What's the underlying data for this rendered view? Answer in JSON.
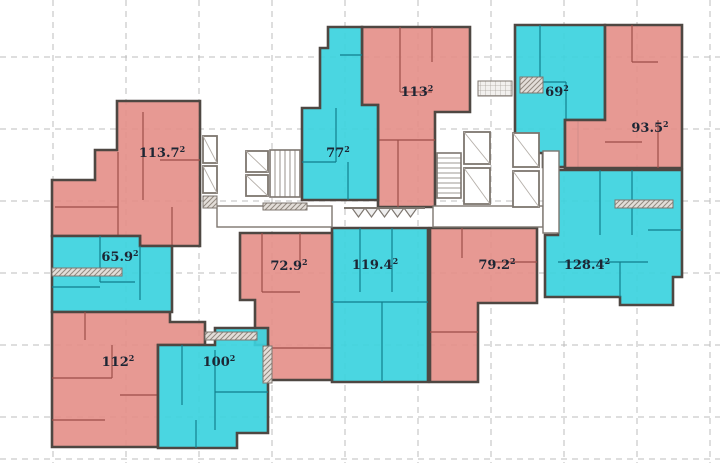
{
  "plan": {
    "colors": {
      "background": "#ffffff",
      "red_fill": "#e5908a",
      "red_wall": "#9c4f49",
      "cyan_fill": "#3bd2de",
      "cyan_wall": "#137f8d",
      "outline": "#4e4742",
      "grid": "#bcbcbc",
      "label": "#1d2634",
      "core": "#7d766f",
      "core_fill": "#ffffff",
      "canopy_fill": "#eeeeee",
      "hatch": "#938a81"
    },
    "grid": {
      "vlines": [
        53,
        126,
        199,
        272,
        345,
        418,
        491,
        564,
        637,
        710
      ],
      "hlines": [
        57,
        129,
        201,
        273,
        345,
        417,
        459
      ],
      "dash": "6 5"
    },
    "units": [
      {
        "id": "unit-113-7",
        "area": "113.7",
        "sup": "2",
        "type": "red",
        "label": [
          162,
          157
        ],
        "points": [
          [
            117,
            101
          ],
          [
            200,
            101
          ],
          [
            200,
            246
          ],
          [
            140,
            246
          ],
          [
            140,
            236
          ],
          [
            52,
            236
          ],
          [
            52,
            180
          ],
          [
            95,
            180
          ],
          [
            95,
            150
          ],
          [
            117,
            150
          ]
        ],
        "walls": [
          [
            143,
            112,
            143,
            200
          ],
          [
            118,
            152,
            118,
            236
          ],
          [
            55,
            207,
            118,
            207
          ],
          [
            160,
            160,
            200,
            160
          ],
          [
            172,
            207,
            172,
            246
          ]
        ]
      },
      {
        "id": "unit-113",
        "area": "113",
        "sup": "2",
        "type": "red",
        "label": [
          417,
          96
        ],
        "points": [
          [
            362,
            27
          ],
          [
            470,
            27
          ],
          [
            470,
            112
          ],
          [
            435,
            112
          ],
          [
            435,
            207
          ],
          [
            378,
            207
          ],
          [
            378,
            105
          ],
          [
            362,
            105
          ]
        ],
        "walls": [
          [
            400,
            27,
            400,
            92
          ],
          [
            400,
            92,
            432,
            92
          ],
          [
            432,
            27,
            432,
            62
          ],
          [
            378,
            140,
            435,
            140
          ],
          [
            398,
            140,
            398,
            207
          ]
        ]
      },
      {
        "id": "unit-69",
        "area": "69",
        "sup": "2",
        "type": "cyan",
        "label": [
          557,
          96
        ],
        "points": [
          [
            515,
            25
          ],
          [
            605,
            25
          ],
          [
            605,
            120
          ],
          [
            565,
            120
          ],
          [
            565,
            167
          ],
          [
            543,
            167
          ],
          [
            543,
            153
          ],
          [
            515,
            153
          ]
        ],
        "walls": [
          [
            540,
            25,
            540,
            82
          ],
          [
            540,
            82,
            566,
            82
          ],
          [
            566,
            82,
            566,
            120
          ],
          [
            578,
            120,
            578,
            167
          ]
        ]
      },
      {
        "id": "unit-93-5",
        "area": "93.5",
        "sup": "2",
        "type": "red",
        "label": [
          650,
          132
        ],
        "points": [
          [
            605,
            25
          ],
          [
            682,
            25
          ],
          [
            682,
            168
          ],
          [
            565,
            168
          ],
          [
            565,
            120
          ],
          [
            605,
            120
          ]
        ],
        "walls": [
          [
            632,
            25,
            632,
            62
          ],
          [
            632,
            62,
            658,
            62
          ],
          [
            605,
            142,
            642,
            142
          ],
          [
            658,
            120,
            658,
            168
          ]
        ]
      },
      {
        "id": "unit-77",
        "area": "77",
        "sup": "2",
        "type": "cyan",
        "label": [
          338,
          157
        ],
        "points": [
          [
            328,
            27
          ],
          [
            362,
            27
          ],
          [
            362,
            105
          ],
          [
            378,
            105
          ],
          [
            378,
            200
          ],
          [
            302,
            200
          ],
          [
            302,
            108
          ],
          [
            320,
            108
          ],
          [
            320,
            48
          ],
          [
            328,
            48
          ]
        ],
        "walls": [
          [
            336,
            108,
            336,
            162
          ],
          [
            302,
            162,
            336,
            162
          ],
          [
            340,
            55,
            362,
            55
          ],
          [
            348,
            162,
            348,
            200
          ]
        ]
      },
      {
        "id": "unit-65-9",
        "area": "65.9",
        "sup": "2",
        "type": "cyan",
        "label": [
          120,
          261
        ],
        "points": [
          [
            52,
            236
          ],
          [
            140,
            236
          ],
          [
            140,
            246
          ],
          [
            172,
            246
          ],
          [
            172,
            312
          ],
          [
            52,
            312
          ]
        ],
        "walls": [
          [
            100,
            236,
            100,
            282
          ],
          [
            100,
            282,
            135,
            282
          ],
          [
            140,
            246,
            140,
            300
          ],
          [
            52,
            287,
            100,
            287
          ]
        ]
      },
      {
        "id": "unit-72-9",
        "area": "72.9",
        "sup": "2",
        "type": "red",
        "label": [
          289,
          270
        ],
        "points": [
          [
            240,
            233
          ],
          [
            333,
            233
          ],
          [
            333,
            380
          ],
          [
            268,
            380
          ],
          [
            268,
            345
          ],
          [
            255,
            345
          ],
          [
            255,
            300
          ],
          [
            240,
            300
          ]
        ],
        "walls": [
          [
            262,
            233,
            262,
            292
          ],
          [
            262,
            292,
            300,
            292
          ],
          [
            300,
            233,
            300,
            262
          ],
          [
            272,
            348,
            333,
            348
          ]
        ]
      },
      {
        "id": "unit-119-4",
        "area": "119.4",
        "sup": "2",
        "type": "cyan",
        "label": [
          375,
          269
        ],
        "points": [
          [
            332,
            228
          ],
          [
            428,
            228
          ],
          [
            428,
            382
          ],
          [
            332,
            382
          ]
        ],
        "walls": [
          [
            360,
            228,
            360,
            292
          ],
          [
            392,
            228,
            392,
            292
          ],
          [
            332,
            302,
            428,
            302
          ],
          [
            382,
            302,
            382,
            382
          ]
        ]
      },
      {
        "id": "unit-79-2",
        "area": "79.2",
        "sup": "2",
        "type": "red",
        "label": [
          497,
          269
        ],
        "points": [
          [
            430,
            228
          ],
          [
            537,
            228
          ],
          [
            537,
            303
          ],
          [
            478,
            303
          ],
          [
            478,
            382
          ],
          [
            430,
            382
          ]
        ],
        "walls": [
          [
            462,
            228,
            462,
            258
          ],
          [
            492,
            262,
            537,
            262
          ],
          [
            430,
            332,
            478,
            332
          ]
        ]
      },
      {
        "id": "unit-128-4",
        "area": "128.4",
        "sup": "2",
        "type": "cyan",
        "label": [
          587,
          269
        ],
        "points": [
          [
            558,
            170
          ],
          [
            682,
            170
          ],
          [
            682,
            277
          ],
          [
            673,
            277
          ],
          [
            673,
            305
          ],
          [
            620,
            305
          ],
          [
            620,
            297
          ],
          [
            545,
            297
          ],
          [
            545,
            235
          ],
          [
            558,
            235
          ]
        ],
        "walls": [
          [
            600,
            170,
            600,
            235
          ],
          [
            632,
            170,
            632,
            235
          ],
          [
            558,
            262,
            600,
            262
          ],
          [
            620,
            262,
            620,
            297
          ],
          [
            648,
            230,
            682,
            230
          ],
          [
            600,
            262,
            648,
            262
          ]
        ]
      },
      {
        "id": "unit-112",
        "area": "112",
        "sup": "2",
        "type": "red",
        "label": [
          118,
          366
        ],
        "points": [
          [
            52,
            312
          ],
          [
            170,
            312
          ],
          [
            170,
            322
          ],
          [
            205,
            322
          ],
          [
            205,
            345
          ],
          [
            158,
            345
          ],
          [
            158,
            447
          ],
          [
            52,
            447
          ]
        ],
        "walls": [
          [
            52,
            378,
            112,
            378
          ],
          [
            112,
            345,
            112,
            378
          ],
          [
            85,
            312,
            85,
            340
          ],
          [
            120,
            395,
            158,
            395
          ],
          [
            52,
            420,
            105,
            420
          ]
        ]
      },
      {
        "id": "unit-100",
        "area": "100",
        "sup": "2",
        "type": "cyan",
        "label": [
          219,
          366
        ],
        "points": [
          [
            158,
            345
          ],
          [
            215,
            345
          ],
          [
            215,
            328
          ],
          [
            268,
            328
          ],
          [
            268,
            433
          ],
          [
            237,
            433
          ],
          [
            237,
            448
          ],
          [
            158,
            448
          ]
        ],
        "walls": [
          [
            215,
            350,
            215,
            430
          ],
          [
            215,
            392,
            268,
            392
          ],
          [
            182,
            345,
            182,
            405
          ],
          [
            196,
            420,
            196,
            448
          ]
        ]
      }
    ],
    "cores": {
      "stairs": [
        {
          "x": 270,
          "y": 150,
          "w": 30,
          "h": 47,
          "dir": "v"
        },
        {
          "x": 437,
          "y": 153,
          "w": 24,
          "h": 45,
          "dir": "h"
        }
      ],
      "lifts": [
        {
          "x": 246,
          "y": 151,
          "w": 22,
          "h": 21
        },
        {
          "x": 246,
          "y": 175,
          "w": 22,
          "h": 21
        },
        {
          "x": 464,
          "y": 132,
          "w": 26,
          "h": 32
        },
        {
          "x": 464,
          "y": 168,
          "w": 26,
          "h": 36
        },
        {
          "x": 513,
          "y": 133,
          "w": 26,
          "h": 34
        },
        {
          "x": 513,
          "y": 171,
          "w": 26,
          "h": 36
        },
        {
          "x": 203,
          "y": 136,
          "w": 14,
          "h": 27
        },
        {
          "x": 203,
          "y": 166,
          "w": 14,
          "h": 27
        }
      ],
      "corridors": [
        {
          "x": 217,
          "y": 206,
          "w": 115,
          "h": 21
        },
        {
          "x": 433,
          "y": 206,
          "w": 110,
          "h": 21
        },
        {
          "x": 543,
          "y": 151,
          "w": 16,
          "h": 82
        }
      ],
      "hatches": [
        {
          "x": 52,
          "y": 268,
          "w": 70,
          "h": 8
        },
        {
          "x": 205,
          "y": 332,
          "w": 52,
          "h": 8
        },
        {
          "x": 263,
          "y": 346,
          "w": 9,
          "h": 37
        },
        {
          "x": 203,
          "y": 196,
          "w": 14,
          "h": 12
        },
        {
          "x": 520,
          "y": 77,
          "w": 23,
          "h": 16
        },
        {
          "x": 615,
          "y": 200,
          "w": 58,
          "h": 8
        },
        {
          "x": 263,
          "y": 203,
          "w": 44,
          "h": 7
        }
      ],
      "grid_box": {
        "x": 478,
        "y": 81,
        "w": 34,
        "h": 15
      },
      "canopy": {
        "x": 352,
        "y": 208,
        "teeth": 5,
        "tw": 13,
        "depth": 9
      }
    }
  }
}
